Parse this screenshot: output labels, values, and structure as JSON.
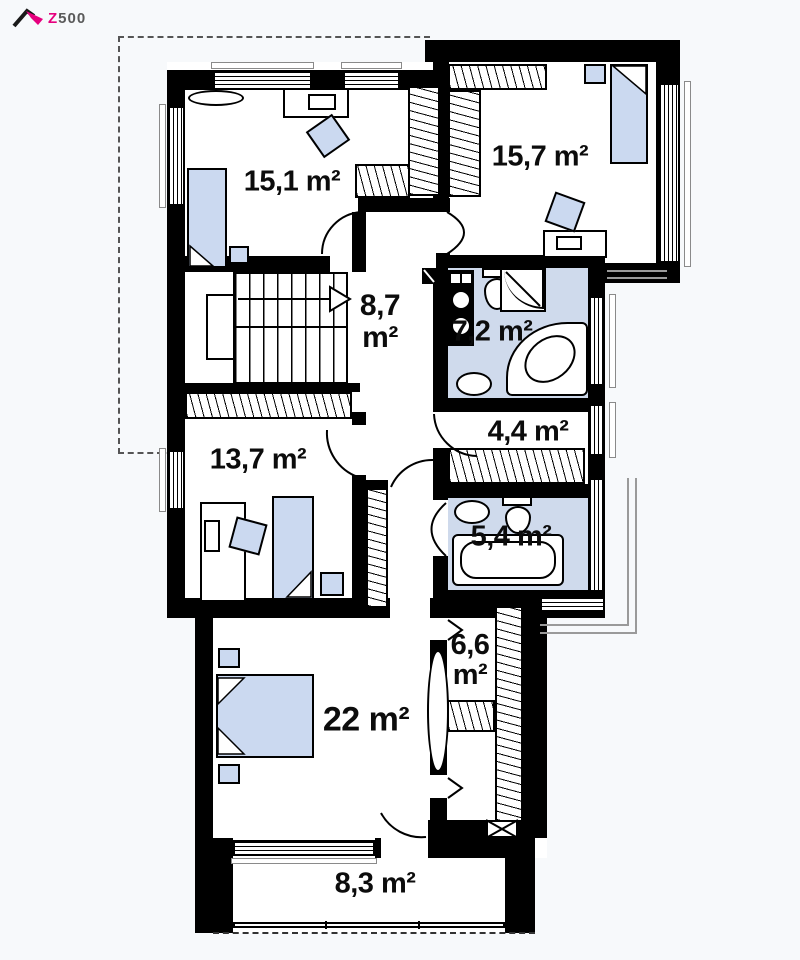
{
  "logo": {
    "z": "Z",
    "suffix": "500"
  },
  "plan_title": "first-floor-plan",
  "rooms": [
    {
      "name": "bedroom-top-left",
      "area": "15,1 m²"
    },
    {
      "name": "bedroom-top-right",
      "area": "15,7 m²"
    },
    {
      "name": "hall-stairs",
      "value": "8,7",
      "unit": "m²"
    },
    {
      "name": "bathroom-large",
      "area": "7,2 m²"
    },
    {
      "name": "wardrobe-small",
      "area": "4,4 m²"
    },
    {
      "name": "bedroom-middle",
      "area": "13,7 m²"
    },
    {
      "name": "bathroom-small",
      "area": "5,4 m²"
    },
    {
      "name": "walk-in-closet",
      "value": "6,6",
      "unit": "m²"
    },
    {
      "name": "master-bedroom",
      "area": "22 m²"
    },
    {
      "name": "balcony",
      "area": "8,3 m²"
    }
  ],
  "colors": {
    "wall": "#000000",
    "bathroom_floor": "#cfdaec",
    "furniture": "#cbd9f0",
    "logo_accent": "#e6007e",
    "logo_text": "#5a5a5a",
    "background": "#f7f9fb"
  }
}
